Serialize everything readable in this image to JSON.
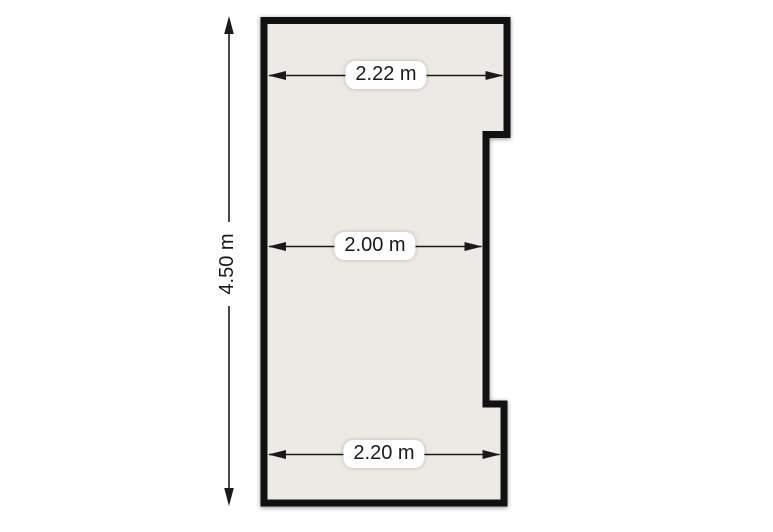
{
  "diagram": {
    "kind": "floor-plan",
    "room_fill_color": "#edeae5",
    "wall_color": "#111111",
    "dimension_line_color": "#1a1a1a",
    "background_color": "#ffffff",
    "dimensions": {
      "height": {
        "label": "4.50 m",
        "orientation": "vertical",
        "position": "left-exterior"
      },
      "top_width": {
        "label": "2.22 m",
        "orientation": "horizontal",
        "position": "top-interior"
      },
      "middle_width": {
        "label": "2.00 m",
        "orientation": "horizontal",
        "position": "middle-interior"
      },
      "bottom_width": {
        "label": "2.20 m",
        "orientation": "horizontal",
        "position": "bottom-interior"
      }
    }
  }
}
